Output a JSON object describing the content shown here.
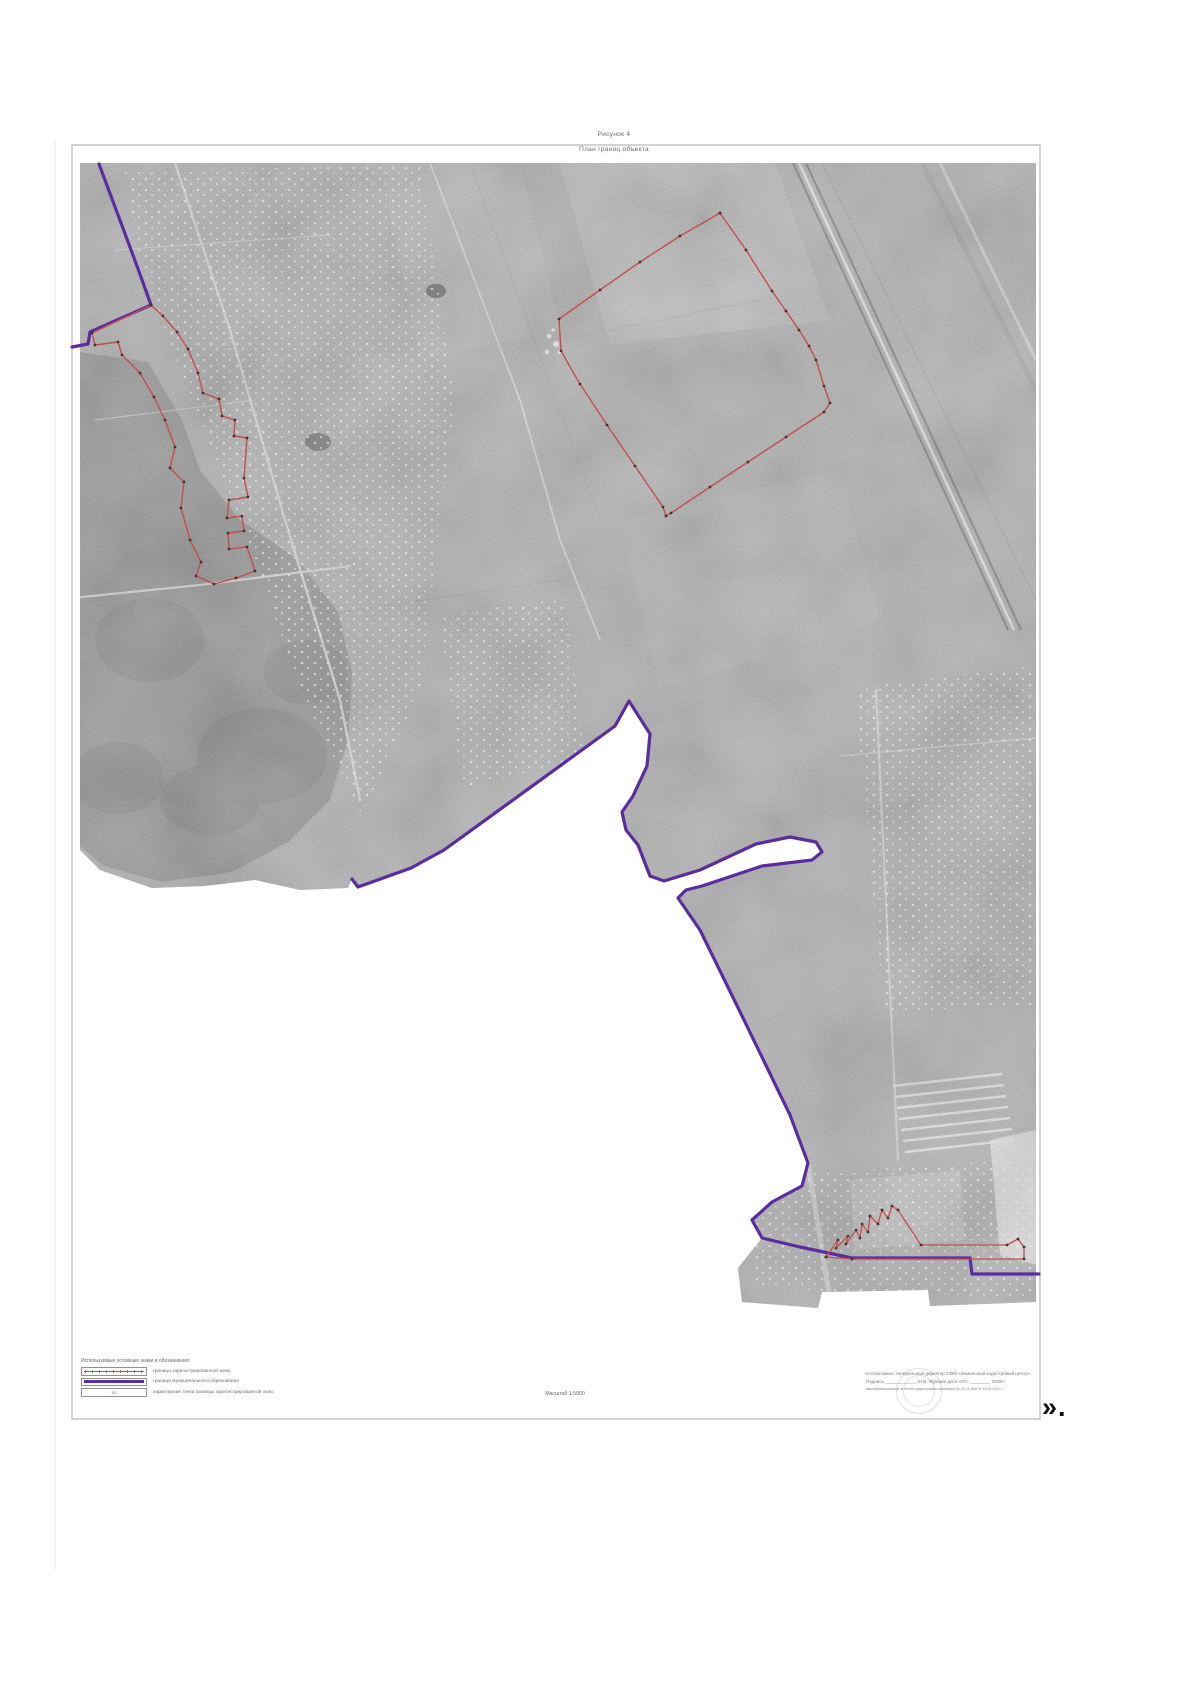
{
  "page": {
    "figure_label": "Рисунок 4",
    "figure_title": "План границ объекта"
  },
  "legend": {
    "header": "Используемые условные знаки и обозначения:",
    "items": [
      {
        "symbol": "zone-boundary-swatch",
        "label": "граница зарегистрированной зоны"
      },
      {
        "symbol": "municipal-boundary-swatch",
        "label": "граница муниципального образования"
      },
      {
        "symbol": "point-swatch",
        "point_label": "н1",
        "label": "характерная точка границы зарегистрированной зоны"
      }
    ]
  },
  "scale": {
    "label": "Масштаб 1:5000"
  },
  "approval": {
    "line1": "Согласовано: генеральный директор ООО «Земельный кадастровый центр»",
    "line2": "Подпись ____________ /Н.В. Жукова/      дата «27» ________ 2008 г.",
    "line3": "квалификационный аттестат кадастрового инженера № 23-11-568 от 14.02.2011 г."
  },
  "corner_mark": "».",
  "map": {
    "colors": {
      "zone_boundary": "#c0504d",
      "municipal_boundary": "#5a2ca0",
      "imagery_base": "#a9a9a9",
      "forest": "#868686"
    }
  }
}
